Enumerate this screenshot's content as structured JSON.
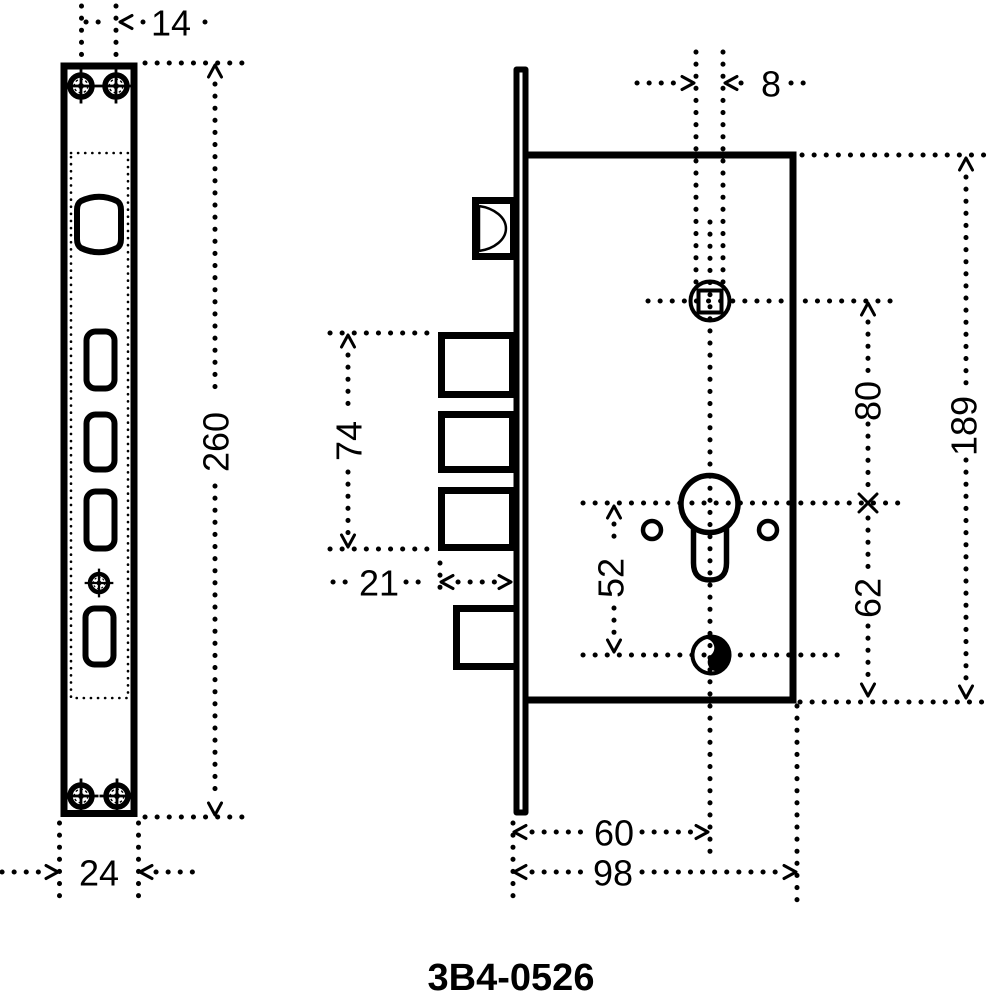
{
  "part_number": "3B4-0526",
  "colors": {
    "ink": "#000000",
    "background": "#ffffff"
  },
  "dimensions": {
    "screw_span_top": "14",
    "plate_length": "260",
    "plate_width": "24",
    "follower_square": "8",
    "bolt_span": "74",
    "bolt_throw": "21",
    "cylinder_to_screw": "52",
    "follower_to_cylinder": "80",
    "cylinder_to_case_bottom": "62",
    "case_height": "189",
    "backset": "60",
    "case_depth": "98"
  }
}
